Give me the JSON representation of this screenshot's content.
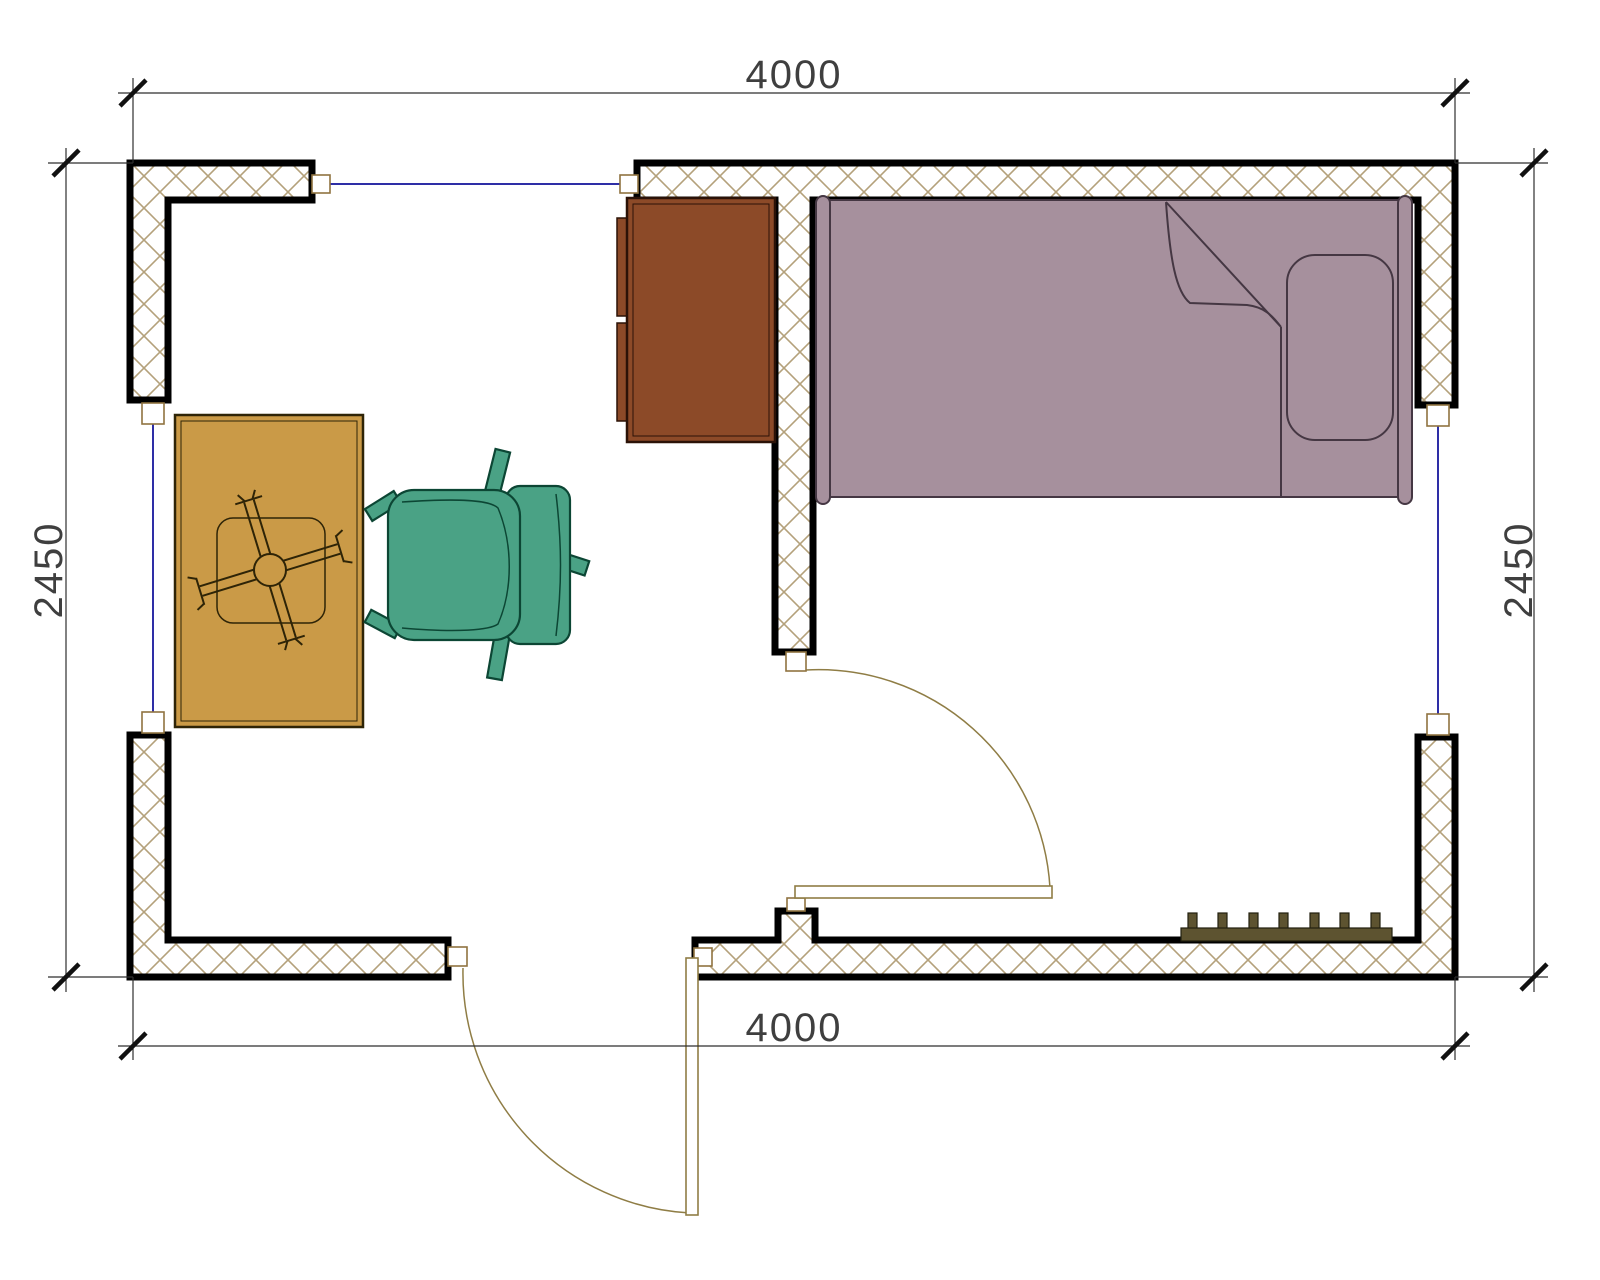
{
  "drawing": {
    "type": "architectural-floor-plan",
    "description": "top view plan of a single room with bed, dresser, table, office chair, radiator, two doors and three windows"
  },
  "dimensions": {
    "top": "4000",
    "bottom": "4000",
    "left": "2450",
    "right": "2450"
  },
  "colors": {
    "background": "#ffffff",
    "wall_border": "#000000",
    "wall_hatch": "#b4a17b",
    "window": "#2e2ea6",
    "frame_box": "#8f7340",
    "door": "#8f7d45",
    "dimension_line": "#2f2f2f",
    "tick": "#111111",
    "dimension_text": "#3f3f3f",
    "bed_fill": "#a6909d",
    "bed_outline": "#453743",
    "dresser_fill": "#8c4a28",
    "dresser_outline": "#2b1207",
    "table_fill": "#ca9a47",
    "table_outline": "#2e2407",
    "chair_fill": "#4aa285",
    "chair_outline": "#0c4634",
    "radiator_fill": "#5d5330",
    "radiator_outline": "#22200f"
  },
  "elements": {
    "windows": [
      "top window",
      "left window",
      "right window"
    ],
    "doors": [
      "interior partition door",
      "exterior entry door"
    ],
    "furniture": [
      "single bed with pillow and folded blanket",
      "dresser",
      "table with cross pedestal base",
      "office swivel chair",
      "radiator"
    ]
  }
}
